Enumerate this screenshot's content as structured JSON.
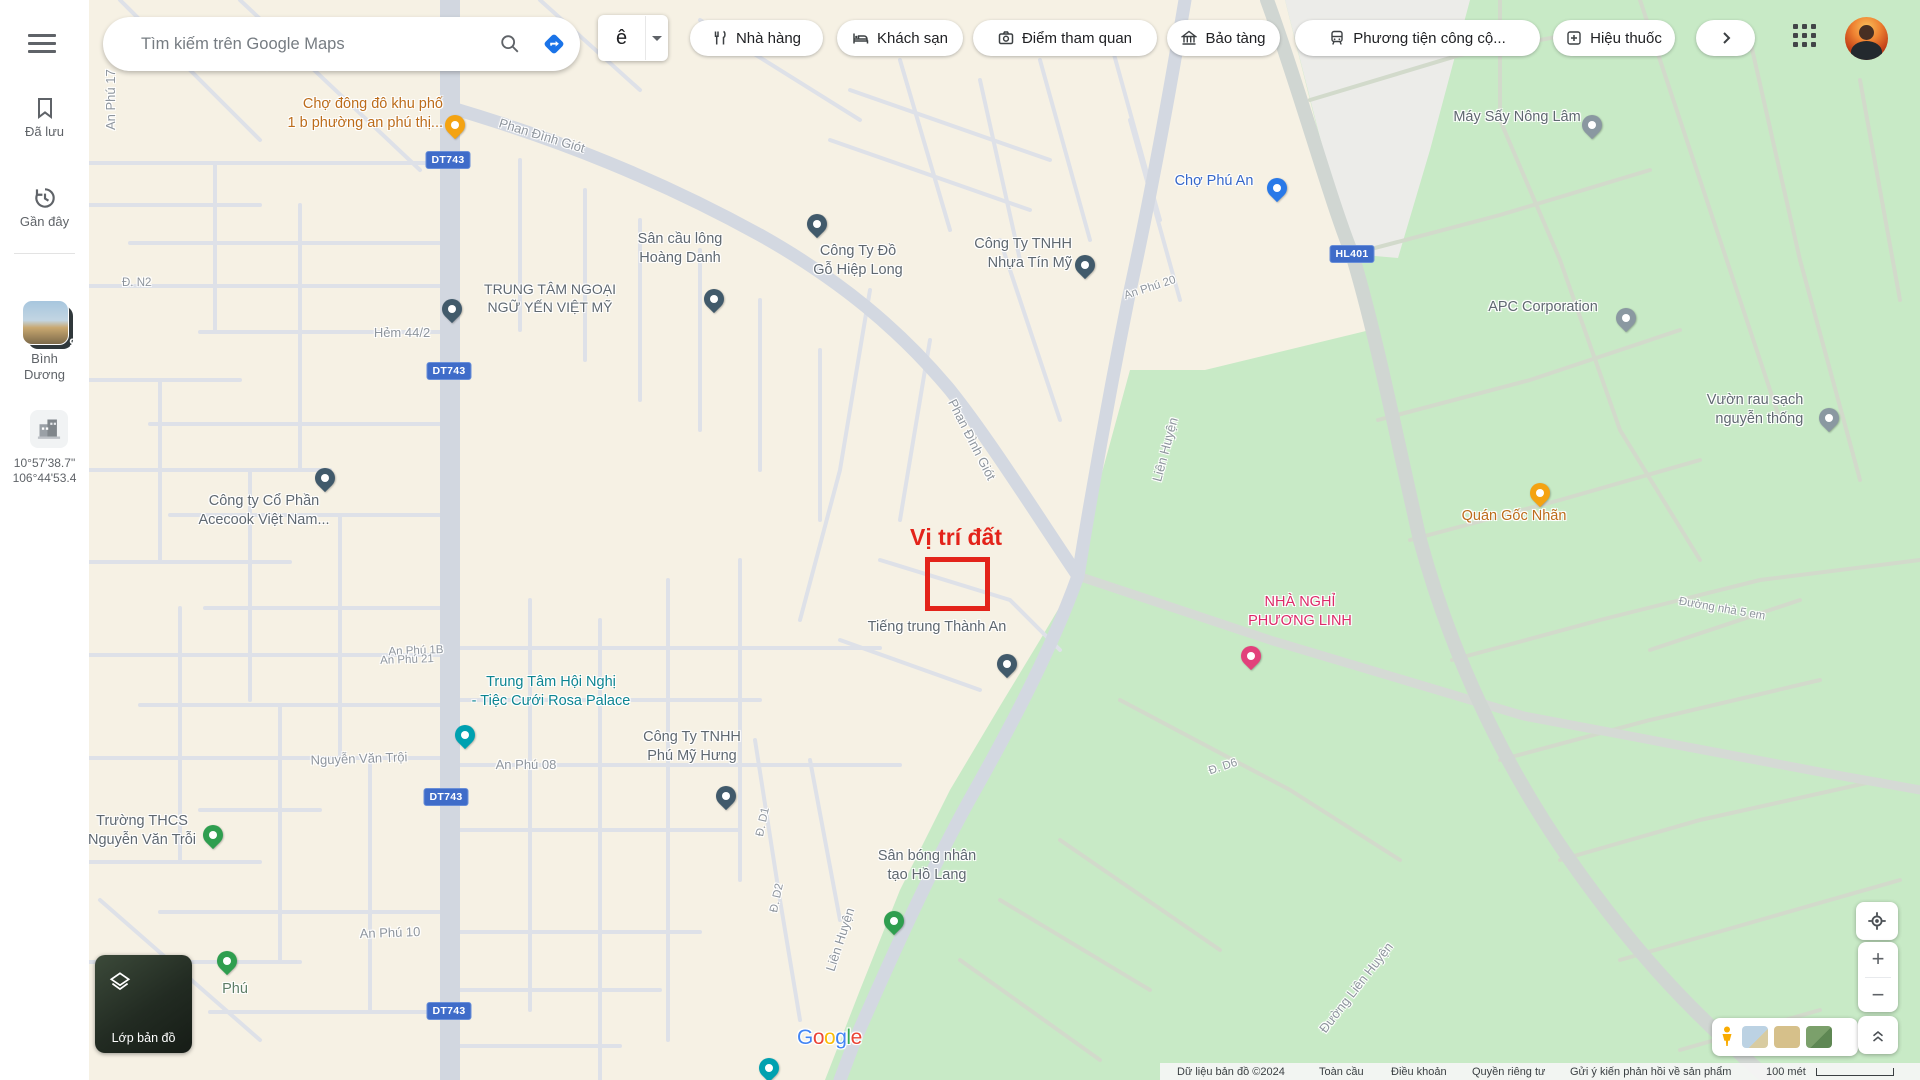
{
  "topbar": {
    "search": {
      "placeholder": "Tìm kiếm trên Google Maps"
    },
    "ime": {
      "label": "ê"
    },
    "chips": [
      {
        "icon": "restaurant-icon",
        "label": "Nhà hàng"
      },
      {
        "icon": "hotel-icon",
        "label": "Khách sạn"
      },
      {
        "icon": "camera-icon",
        "label": "Điểm tham quan"
      },
      {
        "icon": "museum-icon",
        "label": "Bảo tàng"
      },
      {
        "icon": "transit-icon",
        "label": "Phương tiện công cộ..."
      },
      {
        "icon": "pharmacy-icon",
        "label": "Hiệu thuốc"
      }
    ]
  },
  "sidebar": {
    "saved_label": "Đã lưu",
    "recent_label": "Gần đây",
    "place": {
      "line1": "Bình",
      "line2": "Dương",
      "badge": "9"
    },
    "coords": {
      "line1": "10°57'38.7\"",
      "line2": "106°44'53.4"
    }
  },
  "map": {
    "annotation": {
      "title": "Vị trí đất"
    },
    "shields": {
      "dt743": "DT743",
      "hl401": "HL401"
    },
    "watermark": "Google",
    "streets": {
      "an_phu_17": "An Phú 17",
      "ersi": "ersi",
      "d_n2": "Đ. N2",
      "hem_44_2": "Hẻm 44/2",
      "phan_dinh_giot": "Phan Đình Giót",
      "an_phu_20": "An Phú 20",
      "an_phu_1b": "An Phú 1B",
      "nguyen_van_troi": "Nguyễn Văn Trội",
      "an_phu_08": "An Phú 08",
      "an_phu_21": "An Phú 21",
      "an_phu_10": "An Phú 10",
      "lien_huyen": "Liên Huyện",
      "duong_lien_huyen": "Đường Liên Huyện",
      "d_d1": "Đ. D1",
      "d_d2": "Đ. D2",
      "d_d6": "Đ. D6",
      "duong_nha_5_em": "Đường nhà 5 em",
      "ng": "ng"
    },
    "pois": {
      "cho_dong_do": {
        "l1": "Chợ đông đô khu phố",
        "l2": "1 b phường an phú thị..."
      },
      "trung_tam_nn": {
        "l1": "TRUNG TÂM NGOẠI",
        "l2": "NGỮ YẾN VIỆT MỸ"
      },
      "san_cau_long": {
        "l1": "Sân cầu lông",
        "l2": "Hoàng Danh"
      },
      "hiep_long": {
        "l1": "Công Ty Đồ",
        "l2": "Gỗ Hiệp Long"
      },
      "nhua_tin_my": {
        "l1": "Công Ty TNHH",
        "l2": "Nhựa Tín Mỹ"
      },
      "cho_phu_an": {
        "l1": "Chợ Phú An"
      },
      "may_say": {
        "l1": "Máy Sấy Nông Lâm"
      },
      "apc": {
        "l1": "APC Corporation"
      },
      "vuon_rau": {
        "l1": "Vườn rau sạch",
        "l2": "nguyễn thống"
      },
      "quan_goc_nhan": {
        "l1": "Quán Gốc Nhãn"
      },
      "nha_nghi": {
        "l1": "NHÀ NGHỈ",
        "l2": "PHƯƠNG LINH"
      },
      "tieng_trung": {
        "l1": "Tiếng trung Thành An"
      },
      "acecook": {
        "l1": "Công ty Cổ Phần",
        "l2": "Acecook Việt Nam..."
      },
      "rosa": {
        "l1": "Trung Tâm Hội Nghị",
        "l2": "- Tiệc Cưới Rosa Palace"
      },
      "truong_thcs": {
        "l1": "Trường THCS",
        "l2": "Nguyễn Văn Trỗi"
      },
      "phu_my_hung": {
        "l1": "Công Ty TNHH",
        "l2": "Phú Mỹ Hưng"
      },
      "san_bong": {
        "l1": "Sân bóng nhân",
        "l2": "tạo Hồ Lang"
      },
      "phu": {
        "l1": "Phú"
      }
    }
  },
  "controls": {
    "layers_label": "Lớp bản đồ"
  },
  "footer": {
    "attribution": "Dữ liệu bản đồ ©2024",
    "links": [
      "Toàn cầu",
      "Điều khoản",
      "Quyền riêng tư",
      "Gửi ý kiến phản hồi về sản phẩm"
    ],
    "scale_label": "100 mét"
  },
  "colors": {
    "annotation_red": "#e3231a",
    "shield_blue": "#3f6cc9",
    "poi_orange": "#bc6c1a",
    "poi_teal": "#0d8591",
    "poi_pink": "#dc2a68",
    "park_green": "#c8eac6",
    "land_beige": "#f6f1e4"
  }
}
